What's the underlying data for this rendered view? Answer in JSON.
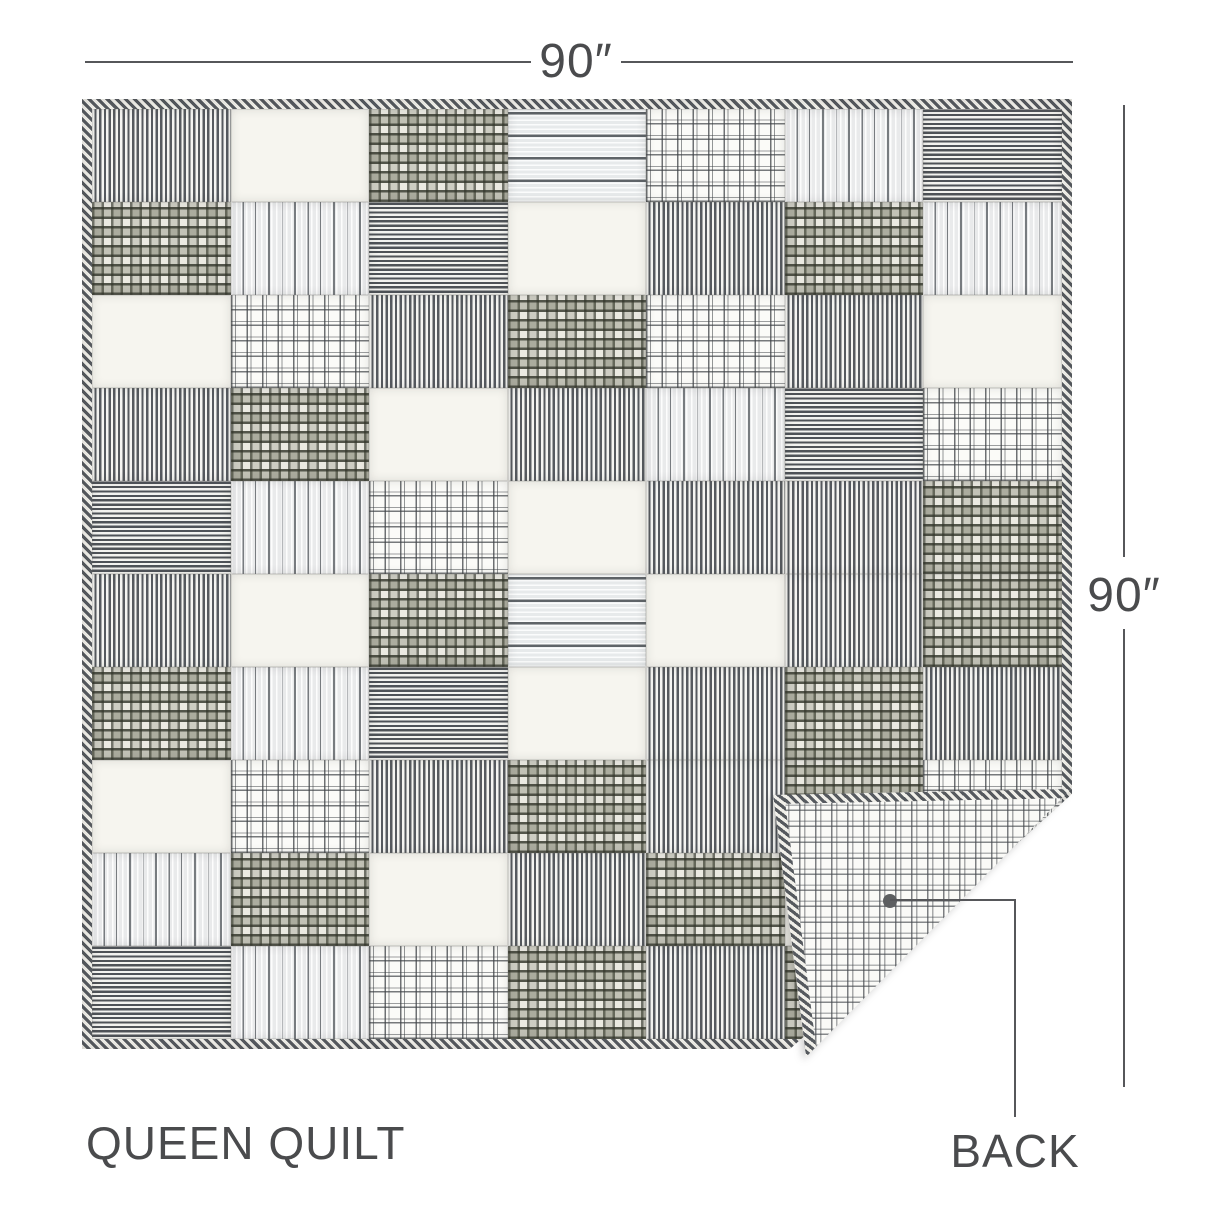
{
  "labels": {
    "width": "90″",
    "height": "90″",
    "product": "QUEEN QUILT",
    "back": "BACK"
  },
  "colors": {
    "ink": "#4a4b4d",
    "line": "#56575a",
    "fabric_dark": "#565a5f",
    "fabric_ink": "#3f4238",
    "fabric_olive": "#6d705e",
    "fabric_cream": "#f6f5ef",
    "dot": "#5d5f61"
  },
  "quilt": {
    "front": {
      "rows": 10,
      "cols": 7,
      "binding_pattern": "diagonal ticking stripe",
      "pattern_names": {
        "tick": "dark ticking stripe (vertical)",
        "hstripe": "dark ticking stripe (horizontal)",
        "vmulti": "gray multi-stripe (vertical)",
        "hmulti": "gray multi-stripe (horizontal)",
        "white": "solid cream",
        "dkplaid": "dark olive plaid",
        "ltplaid": "white windowpane plaid"
      },
      "grid": [
        [
          "tick",
          "white",
          "dkplaid",
          "hmulti",
          "ltplaid",
          "vmulti",
          "hstripe"
        ],
        [
          "dkplaid",
          "vmulti",
          "hstripe",
          "white",
          "tick",
          "dkplaid",
          "vmulti"
        ],
        [
          "white",
          "ltplaid",
          "tick",
          "dkplaid",
          "ltplaid",
          "tick",
          "white"
        ],
        [
          "tick",
          "dkplaid",
          "white",
          "tick",
          "vmulti",
          "hstripe",
          "ltplaid"
        ],
        [
          "hstripe",
          "vmulti",
          "ltplaid",
          "white",
          "tick",
          "tick",
          "dkplaid"
        ],
        [
          "tick",
          "white",
          "dkplaid",
          "hmulti",
          "white",
          "tick",
          "dkplaid"
        ],
        [
          "dkplaid",
          "vmulti",
          "hstripe",
          "white",
          "tick",
          "dkplaid",
          "tick"
        ],
        [
          "white",
          "ltplaid",
          "tick",
          "dkplaid",
          "tick",
          "dkplaid",
          "ltplaid"
        ],
        [
          "vmulti",
          "dkplaid",
          "white",
          "tick",
          "dkplaid",
          "white",
          "tick"
        ],
        [
          "hstripe",
          "vmulti",
          "ltplaid",
          "dkplaid",
          "tick",
          "dkplaid",
          "white"
        ]
      ]
    },
    "back": {
      "pattern": "white windowpane plaid"
    }
  }
}
